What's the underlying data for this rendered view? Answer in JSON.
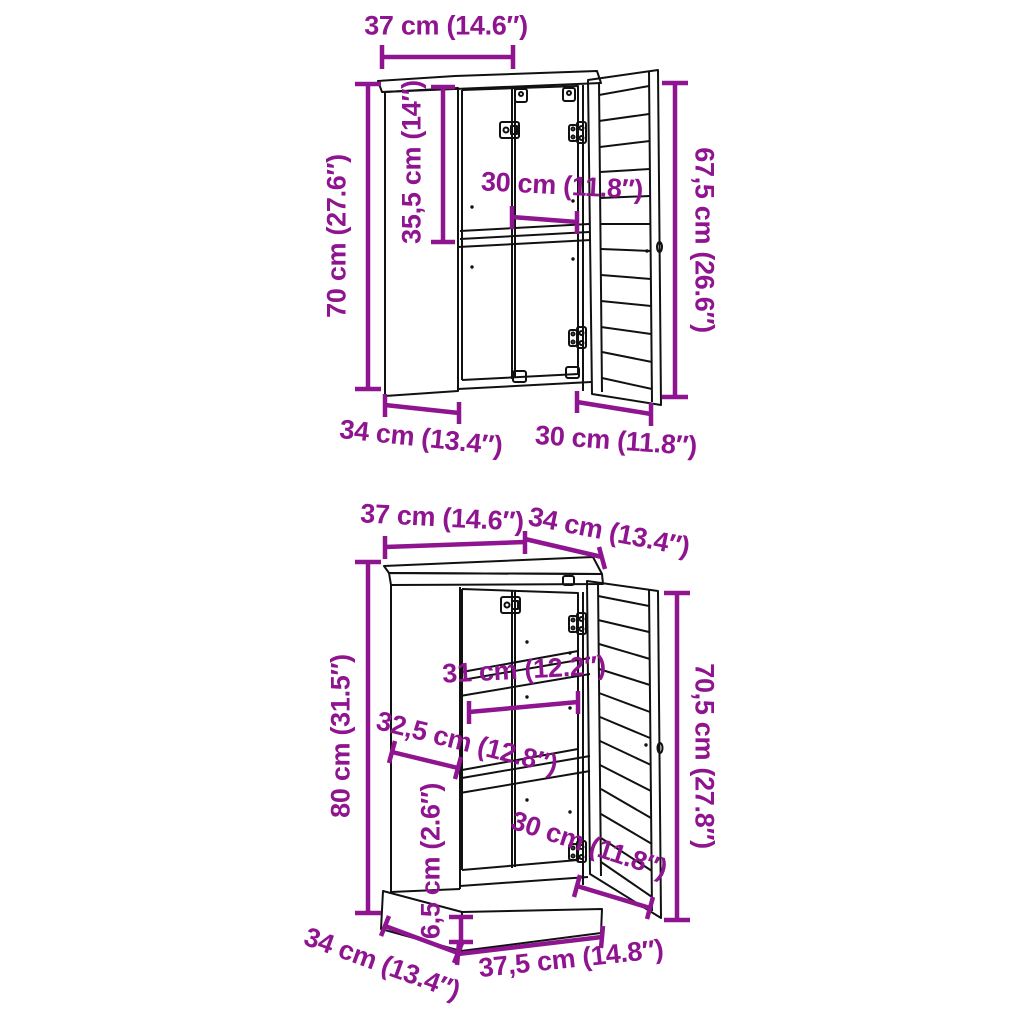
{
  "image": {
    "type": "furniture-dimension-diagram",
    "background": "#ffffff"
  },
  "colors": {
    "dimension_annotation": "#8F148F",
    "line_art": "#111111"
  },
  "wall_cabinet": {
    "name": "wall cabinet with open louvered door",
    "dims": {
      "top_depth": "37 cm (14.6″)",
      "height_left": "70 cm (27.6″)",
      "interior_height": "35,5 cm (14″)",
      "interior_width": "30 cm (11.8″)",
      "height_right": "67,5 cm (26.6″)",
      "base_depth": "34 cm (13.4″)",
      "door_width": "30 cm (11.8″)"
    }
  },
  "floor_cabinet": {
    "name": "floor cabinet with plinth and open louvered door",
    "dims": {
      "top_width": "37 cm (14.6″)",
      "top_depth": "34 cm (13.4″)",
      "height_left": "80 cm (31.5″)",
      "shelf_width": "31 cm (12.2″)",
      "interior_depth": "32,5 cm (12.8″)",
      "plinth_height": "6,5 cm (2.6″)",
      "door_width": "30 cm (11.8″)",
      "base_depth": "34 cm (13.4″)",
      "base_width": "37,5 cm (14.8″)",
      "height_right": "70,5 cm (27.8″)"
    }
  }
}
